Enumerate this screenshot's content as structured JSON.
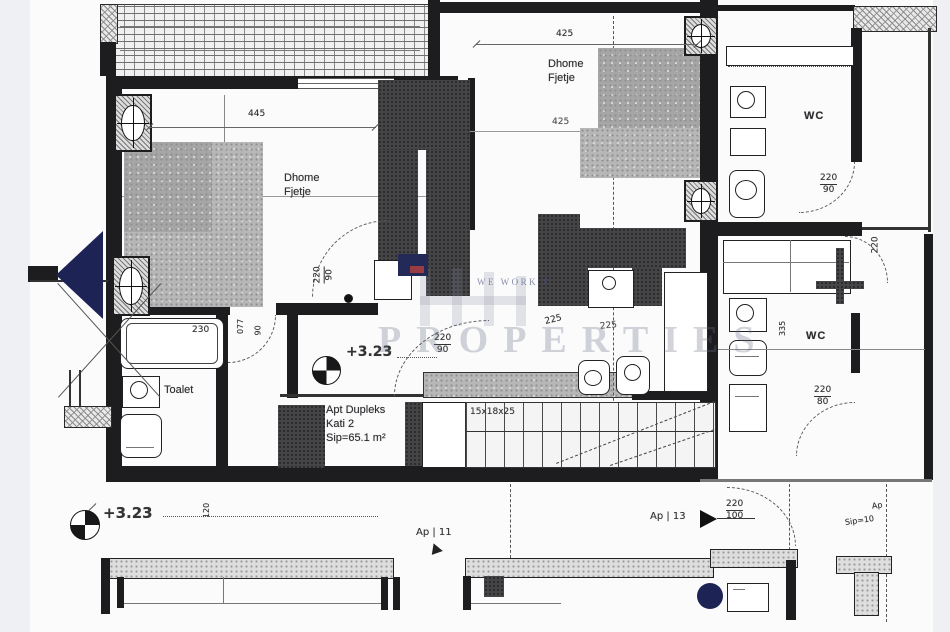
{
  "rooms": {
    "bedroom1": {
      "line1": "Dhome",
      "line2": "Fjetje"
    },
    "bedroom2": {
      "line1": "Dhome",
      "line2": "Fjetje"
    },
    "wc_top": {
      "label": "WC"
    },
    "wc_right": {
      "label": "WC"
    },
    "toalet": {
      "label": "Toalet"
    }
  },
  "apartment": {
    "line1": "Apt Dupleks",
    "line2": "Kati 2",
    "line3": "Sip=65.1 m²"
  },
  "levels": {
    "upper": "+3.23",
    "lower": "+3.23"
  },
  "stairs": {
    "spec": "15x18x25"
  },
  "units": {
    "ap11": "Ap | 11",
    "ap13": "Ap | 13",
    "ap_right": "Ap",
    "sip_right": "Sip=10"
  },
  "dimensions": {
    "bedroom1_width": "445",
    "bedroom2_width": "425",
    "bedroom2_inner": "425",
    "bathtub": "230",
    "closet_a": "225",
    "closet_b": "225",
    "right_room_height": "220",
    "wc_right_width": "335",
    "landing_width": "120",
    "doors": {
      "bed1": {
        "num": "220",
        "den": "90"
      },
      "toalet": {
        "num": "077",
        "den": "90"
      },
      "hall": {
        "num": "220",
        "den": "90"
      },
      "wc_top": {
        "num": "220",
        "den": "90"
      },
      "right": {
        "num": "220",
        "den": "80"
      },
      "entry": {
        "num": "220",
        "den": "100"
      }
    }
  },
  "watermark": {
    "tagline": "WE WORK F",
    "brand": "PROPERTIES"
  },
  "colors": {
    "marker": "#1e2356",
    "wall": "#1d1d1f"
  }
}
